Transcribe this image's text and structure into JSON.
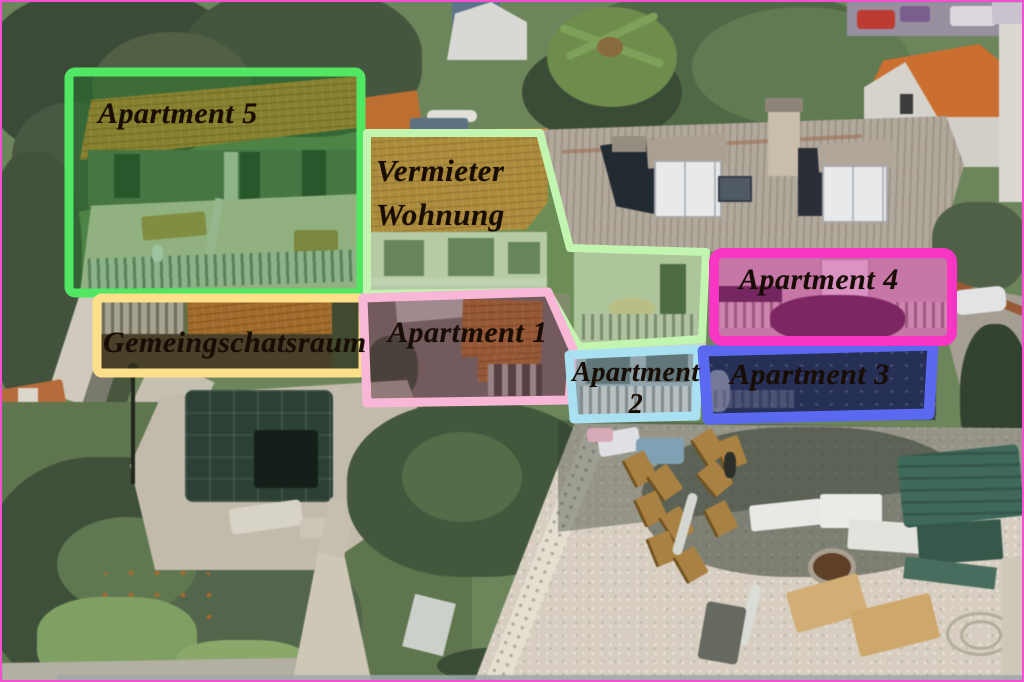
{
  "meta": {
    "description": "Aerial photograph of a guesthouse property with colored boxes labeling the apartments",
    "border_color": "#f44fd4",
    "label_text_color": "#180d05"
  },
  "regions": [
    {
      "id": "apartment-5",
      "lines": [
        "Apartment 5"
      ],
      "outline_color": "#52e763",
      "fill_tint": "rgba(28,130,40,0.38)"
    },
    {
      "id": "vermieter-wohnung",
      "lines": [
        "Vermieter",
        "Wohnung"
      ],
      "outline_color": "#c2f5b0",
      "fill_tint": "rgba(105,165,80,0.30)"
    },
    {
      "id": "gemeinschaftsraum",
      "lines": [
        "Gemeingschatsraum"
      ],
      "outline_color": "#ffe08a",
      "fill_tint": "rgba(70,58,25,0.30)"
    },
    {
      "id": "apartment-1",
      "lines": [
        "Apartment 1"
      ],
      "outline_color": "#f8b7d6",
      "fill_tint": "rgba(84,38,58,0.44)"
    },
    {
      "id": "apartment-2",
      "lines": [
        "Apartment",
        "2"
      ],
      "outline_color": "#a9e1f3",
      "fill_tint": "rgba(125,160,190,0.30)"
    },
    {
      "id": "apartment-3",
      "lines": [
        "Apartment 3"
      ],
      "outline_color": "#5a69ef",
      "fill_tint": "rgba(25,32,95,0.52)"
    },
    {
      "id": "apartment-4",
      "lines": [
        "Apartment 4"
      ],
      "outline_color": "#f936c3",
      "fill_tint": "rgba(198,22,140,0.40)"
    }
  ]
}
